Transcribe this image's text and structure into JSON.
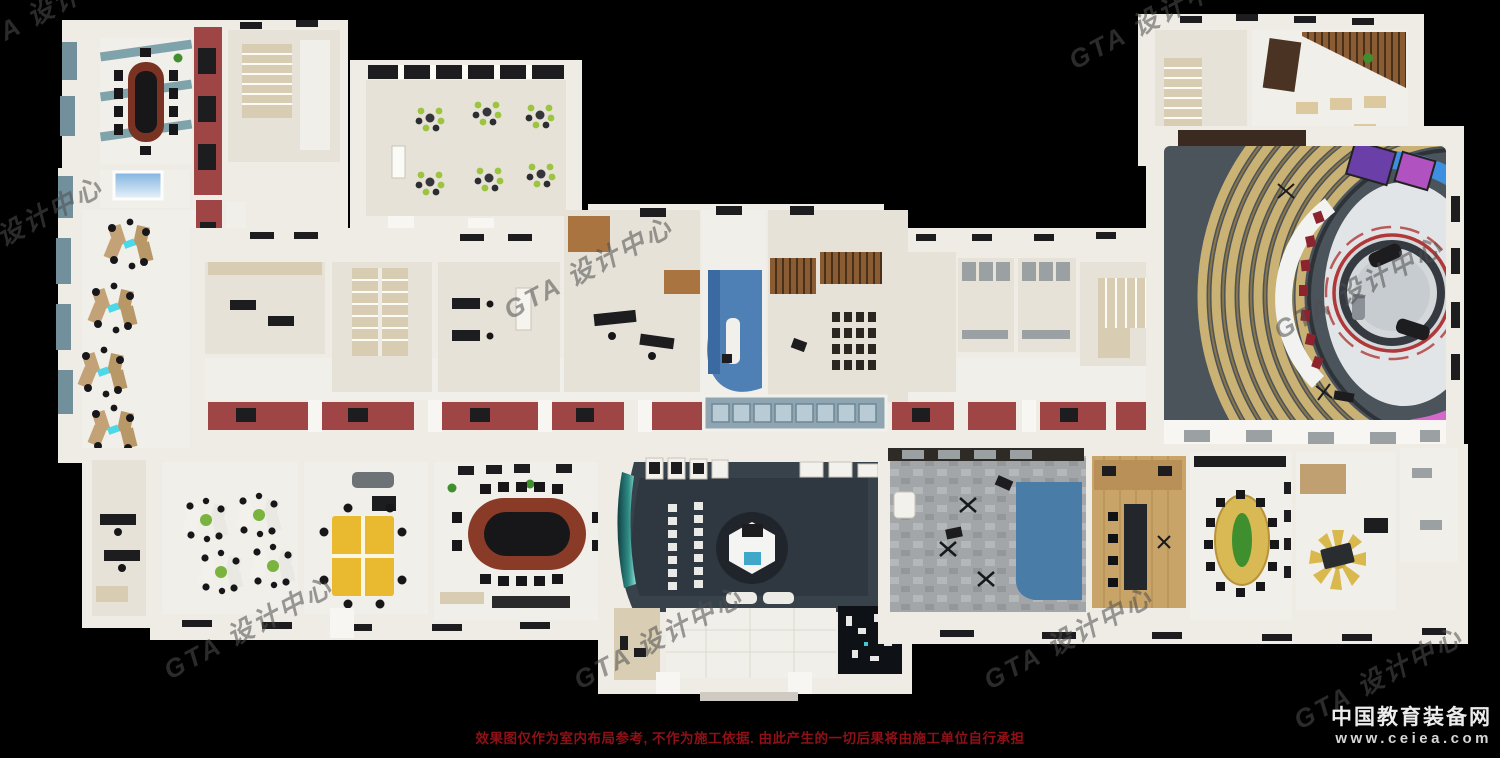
{
  "page": {
    "background": "#000000",
    "width": 1500,
    "height": 758
  },
  "watermarks": {
    "gta": "GTA 设计中心",
    "site_name": "中国教育装备网",
    "site_url": "www.ceiea.com"
  },
  "footer": {
    "disclaimer": "效果图仅作为室内布局参考, 不作为施工依据. 由此产生的一切后果将由施工单位自行承担",
    "disclaimer_color": "#8e1118"
  },
  "render": {
    "type": "3d-floorplan-rendering",
    "colors": {
      "background": "#000000",
      "walls": "#efece5",
      "floor_beige": "#e6e2d8",
      "floor_white": "#f1efe9",
      "accent_red_wall": "#a04545",
      "teal_wall_panel": "#71909c",
      "reception_blue": "#4f80b5",
      "exhibition_floor_dark": "#38424b",
      "studio_floor_dark": "#4b535b",
      "tiered_seating_tan": "#c9b273",
      "led_wall_blue": "#3f8fe0",
      "led_wall_purple": "#a45ce0",
      "led_wall_pink": "#d668cc",
      "yellow_desk": "#e9b92f",
      "round_table_yellow": "#d9b954",
      "green_chair": "#9cc43f",
      "wood_floor": "#c8a468",
      "photo_backdrop_blue": "#4a7ca8"
    },
    "rooms": [
      {
        "name": "conference-room-top-left",
        "feature": "long dark table, black chairs, teal striped floor"
      },
      {
        "name": "computer-lab-left-wing",
        "feature": "4 star-shaped desk clusters with monitors"
      },
      {
        "name": "classroom-green-chairs",
        "feature": "6 clusters of green chairs, dark window band"
      },
      {
        "name": "reception-blue",
        "feature": "blue floor with white desk"
      },
      {
        "name": "training-room-chair-rows",
        "feature": "rows of dark chairs, wood slat wall"
      },
      {
        "name": "restrooms",
        "feature": "stall partitions"
      },
      {
        "name": "stairwells",
        "feature": "tan staircases"
      },
      {
        "name": "tv-studio",
        "feature": "tiered tan seating arc, curved presenter desk with red chairs, circular stage, colorful LED wall"
      },
      {
        "name": "workstation-office",
        "feature": "4 white/green desk clusters"
      },
      {
        "name": "yellow-workstation-office",
        "feature": "yellow desk cluster"
      },
      {
        "name": "oval-conference-room",
        "feature": "red-brown oval table, black chairs"
      },
      {
        "name": "exhibition-hall",
        "feature": "dark floor, hexagonal podium on circular base, chair rows, curved teal glass"
      },
      {
        "name": "entrance-lobby",
        "feature": "white floor, pillars, dark city model sand table"
      },
      {
        "name": "photo-studio",
        "feature": "gray stone floor, blue backdrop, tripods"
      },
      {
        "name": "wood-floor-meeting-room",
        "feature": "dark long table, black chairs"
      },
      {
        "name": "round-table-room",
        "feature": "yellow round table with green plant centerpiece"
      },
      {
        "name": "sunburst-office",
        "feature": "yellow sunburst rug with desk"
      }
    ]
  }
}
